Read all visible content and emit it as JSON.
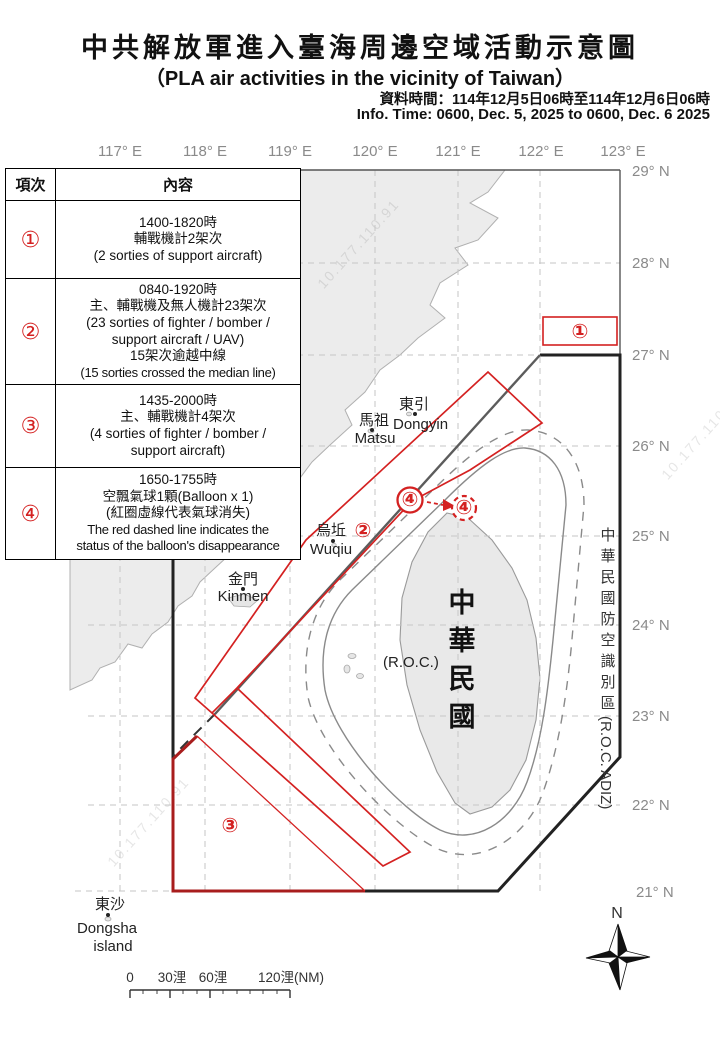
{
  "title": {
    "cjk": "中共解放軍進入臺海周邊空域活動示意圖",
    "en": "（PLA air activities in the vicinity of Taiwan）",
    "info_cjk": "資料時間：114年12月5日06時至114年12月6日06時",
    "info_en": "Info. Time: 0600, Dec. 5, 2025 to 0600, Dec. 6 2025"
  },
  "table": {
    "col_item": "項次",
    "col_content": "內容",
    "rows": [
      {
        "num": "①",
        "lines": [
          "1400-1820時",
          "輔戰機計2架次",
          "(2 sorties of support aircraft)"
        ]
      },
      {
        "num": "②",
        "lines": [
          "0840-1920時",
          "主、輔戰機及無人機計23架次",
          "(23 sorties of fighter / bomber /",
          "support aircraft / UAV)",
          "15架次逾越中線",
          "(15 sorties crossed the median line)"
        ]
      },
      {
        "num": "③",
        "lines": [
          "1435-2000時",
          "主、輔戰機計4架次",
          "(4 sorties of fighter / bomber /",
          "support aircraft)"
        ]
      },
      {
        "num": "④",
        "lines": [
          "1650-1755時",
          "空飄氣球1顆(Balloon x 1)",
          "(紅圈虛線代表氣球消失)",
          "The red dashed line indicates the",
          "status of the balloon's disappearance"
        ]
      }
    ]
  },
  "axes": {
    "lon": [
      "117° E",
      "118° E",
      "119° E",
      "120° E",
      "121° E",
      "122° E",
      "123° E"
    ],
    "lat": [
      "29° N",
      "28° N",
      "27° N",
      "26° N",
      "25° N",
      "24° N",
      "23° N",
      "22° N",
      "21° N"
    ]
  },
  "places": {
    "dongyin_cjk": "東引",
    "dongyin_en": "Dongyin",
    "matsu_cjk": "馬祖",
    "matsu_en": "Matsu",
    "wuqiu_cjk": "烏坵",
    "wuqiu_en": "Wuqiu",
    "kinmen_cjk": "金門",
    "kinmen_en": "Kinmen",
    "dongsha_cjk": "東沙",
    "dongsha_en1": "Dongsha",
    "dongsha_en2": "island",
    "roc_cjk": [
      "中",
      "華",
      "民",
      "國"
    ],
    "roc_en": "(R.O.C.)"
  },
  "adiz": {
    "chars": [
      "中",
      "華",
      "民",
      "國",
      "防",
      "空",
      "識",
      "別",
      "區"
    ],
    "en": "(R.O.C. ADIZ)"
  },
  "markers": {
    "m1": "①",
    "m2": "②",
    "m3": "③",
    "m4_solid": "④",
    "m4_dashed": "④"
  },
  "scalebar": {
    "l0": "0",
    "l30": "30浬",
    "l60": "60浬",
    "l120": "120浬(NM)"
  },
  "compass": {
    "north": "N"
  },
  "watermark": "10.177.110.91",
  "colors": {
    "activity_red": "#d42121",
    "dark_red": "#a81d1d",
    "adiz_black": "#222222",
    "median_gray": "#5c5c5c",
    "contour_gray": "#8a8a8a",
    "land_fill": "#ececec",
    "grid_gray": "#c6c6c6"
  }
}
